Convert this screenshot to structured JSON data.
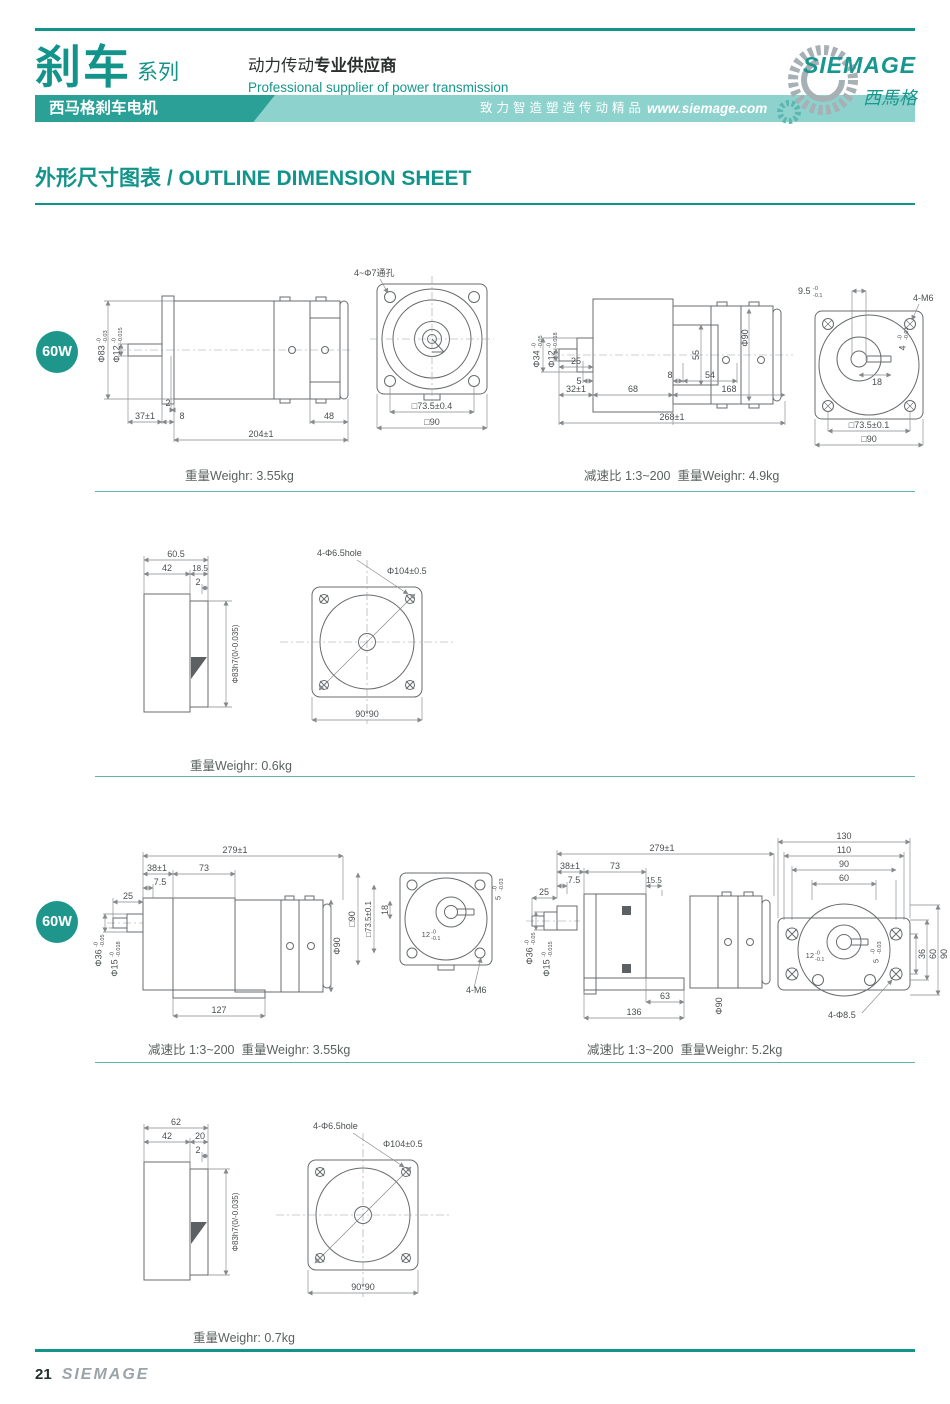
{
  "header": {
    "brand_cn": "刹车",
    "brand_suffix": "系列",
    "supplier_cn_regular": "动力传动",
    "supplier_cn_bold": "专业供应商",
    "supplier_en": "Professional supplier of power transmission",
    "banner_product": "西马格刹车电机",
    "banner_slogan": "致力智造塑造传动精品",
    "banner_url": "www.siemage.com",
    "logo_name": "SIEMAGE",
    "logo_cn": "西馬格"
  },
  "page_title": "外形尺寸图表 / OUTLINE DIMENSION SHEET",
  "badges": {
    "row1": "60W",
    "row3": "60W"
  },
  "captions": {
    "r1_left": "重量Weighr: 3.55kg",
    "r1_right": "减速比 1:3~200  重量Weighr: 4.9kg",
    "r2": "重量Weighr: 0.6kg",
    "r3_left": "减速比 1:3~200  重量Weighr: 3.55kg",
    "r3_right": "减速比 1:3~200  重量Weighr: 5.2kg",
    "r4": "重量Weighr: 0.7kg"
  },
  "drawings": {
    "d1": {
      "dia83": "Φ83",
      "dia83_t": "-0",
      "dia83_b": "-0.03",
      "dia12": "Φ12",
      "dia12_t": "-0",
      "dia12_b": "-0.015",
      "lip": "2",
      "shaft_len": "37±1",
      "flange": "8",
      "total": "204±1",
      "rear": "48"
    },
    "d2": {
      "holes": "4~Φ7通孔",
      "pitch": "□73.5±0.4",
      "square": "□90"
    },
    "d3": {
      "dia34": "Φ34",
      "dia34_t": "-0",
      "dia34_b": "-0.05",
      "dia12": "Φ12",
      "dia12_t": "-0",
      "dia12_b": "-0.018",
      "n25": "25",
      "n5": "5",
      "n32": "32±1",
      "n68": "68",
      "n8": "8",
      "n54": "54",
      "n55": "55",
      "dia90": "Φ90",
      "n168": "168",
      "total": "268±1"
    },
    "d4": {
      "n95": "9.5",
      "n95_t": "-0",
      "n95_b": "-0.1",
      "tap": "4-M6",
      "key": "4",
      "key_t": "-0",
      "key_b": "-0.03",
      "n18": "18",
      "pitch": "□73.5±0.1",
      "square": "□90"
    },
    "d5": {
      "n605": "60.5",
      "n42": "42",
      "n185": "18.5",
      "n2": "2",
      "spigot": "Φ83h7(0/-0.035)"
    },
    "d6": {
      "holes": "4-Φ6.5hole",
      "bolt_circle": "Φ104±0.5",
      "square": "90*90"
    },
    "d7": {
      "total": "279±1",
      "n38": "38±1",
      "n73": "73",
      "n75": "7.5",
      "n25": "25",
      "dia36": "Φ36",
      "dia36_t": "-0",
      "dia36_b": "-0.05",
      "dia15": "Φ15",
      "dia15_t": "-0",
      "dia15_b": "-0.018",
      "n127": "127",
      "dia90": "Φ90"
    },
    "d8": {
      "square": "□90",
      "pitch": "□73.5±0.1",
      "n18": "18",
      "key_w": "12",
      "key_w_t": "-0",
      "key_w_b": "-0.1",
      "key_d": "5",
      "key_d_t": "-0",
      "key_d_b": "-0.03",
      "tap": "4-M6"
    },
    "d9": {
      "total": "279±1",
      "n38": "38±1",
      "n73": "73",
      "n75": "7.5",
      "n155": "15.5",
      "n25": "25",
      "dia36": "Φ36",
      "dia36_t": "-0",
      "dia36_b": "-0.05",
      "dia15": "Φ15",
      "dia15_t": "-0",
      "dia15_b": "-0.015",
      "n63": "63",
      "n136": "136",
      "dia90": "Φ90"
    },
    "d10": {
      "n130": "130",
      "n110": "110",
      "n90": "90",
      "n60": "60",
      "v36": "36",
      "v60": "60",
      "v90": "90",
      "key_w": "12",
      "key_w_t": "-0",
      "key_w_b": "-0.1",
      "key_d": "5",
      "key_d_t": "-0",
      "key_d_b": "-0.03",
      "holes": "4-Φ8.5"
    },
    "d11": {
      "n62": "62",
      "n42": "42",
      "n20": "20",
      "n2": "2",
      "spigot": "Φ83h7(0/-0.035)"
    },
    "d12": {
      "holes": "4-Φ6.5hole",
      "bolt_circle": "Φ104±0.5",
      "square": "90*90"
    }
  },
  "footer": {
    "page": "21",
    "brand": "SIEMAGE"
  }
}
